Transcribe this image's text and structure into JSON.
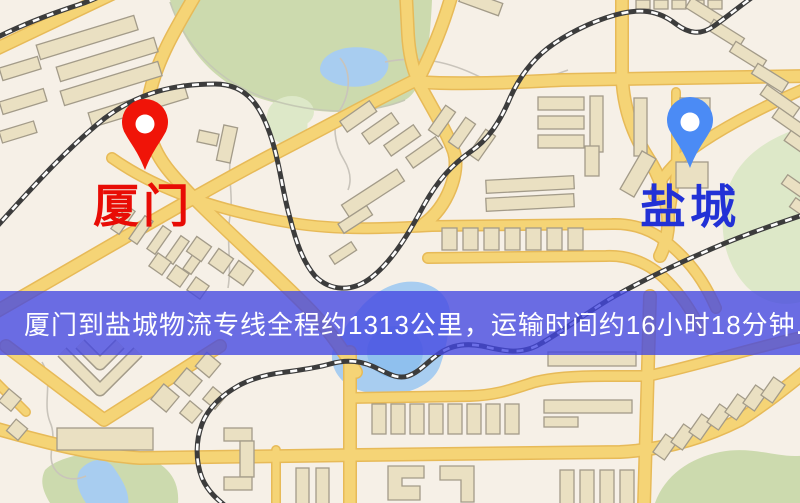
{
  "page": {
    "width": 800,
    "height": 503,
    "kind": "logistics-route-map"
  },
  "banner": {
    "text": "厦门到盐城物流专线全程约1313公里，运输时间约16小时18分钟.",
    "background": "#4347e2",
    "text_color": "#ffffff"
  },
  "origin": {
    "label": "厦门",
    "label_color": "#e80c05",
    "pin_color": "#f01408",
    "pin_icon": "map-pin"
  },
  "destination": {
    "label": "盐城",
    "label_color": "#2231d6",
    "pin_color": "#4b8bf5",
    "pin_icon": "map-pin"
  },
  "route": {
    "distance_text": "约1313公里",
    "duration_text": "约16小时18分钟"
  },
  "map_colors": {
    "background": "#f6f0e7",
    "road": "#f5d476",
    "road_casing": "#e7ba58",
    "building": "#eae0c2",
    "green": "#ccdaae",
    "water": "#a8cdf0",
    "railway": "#3c3c3c"
  }
}
